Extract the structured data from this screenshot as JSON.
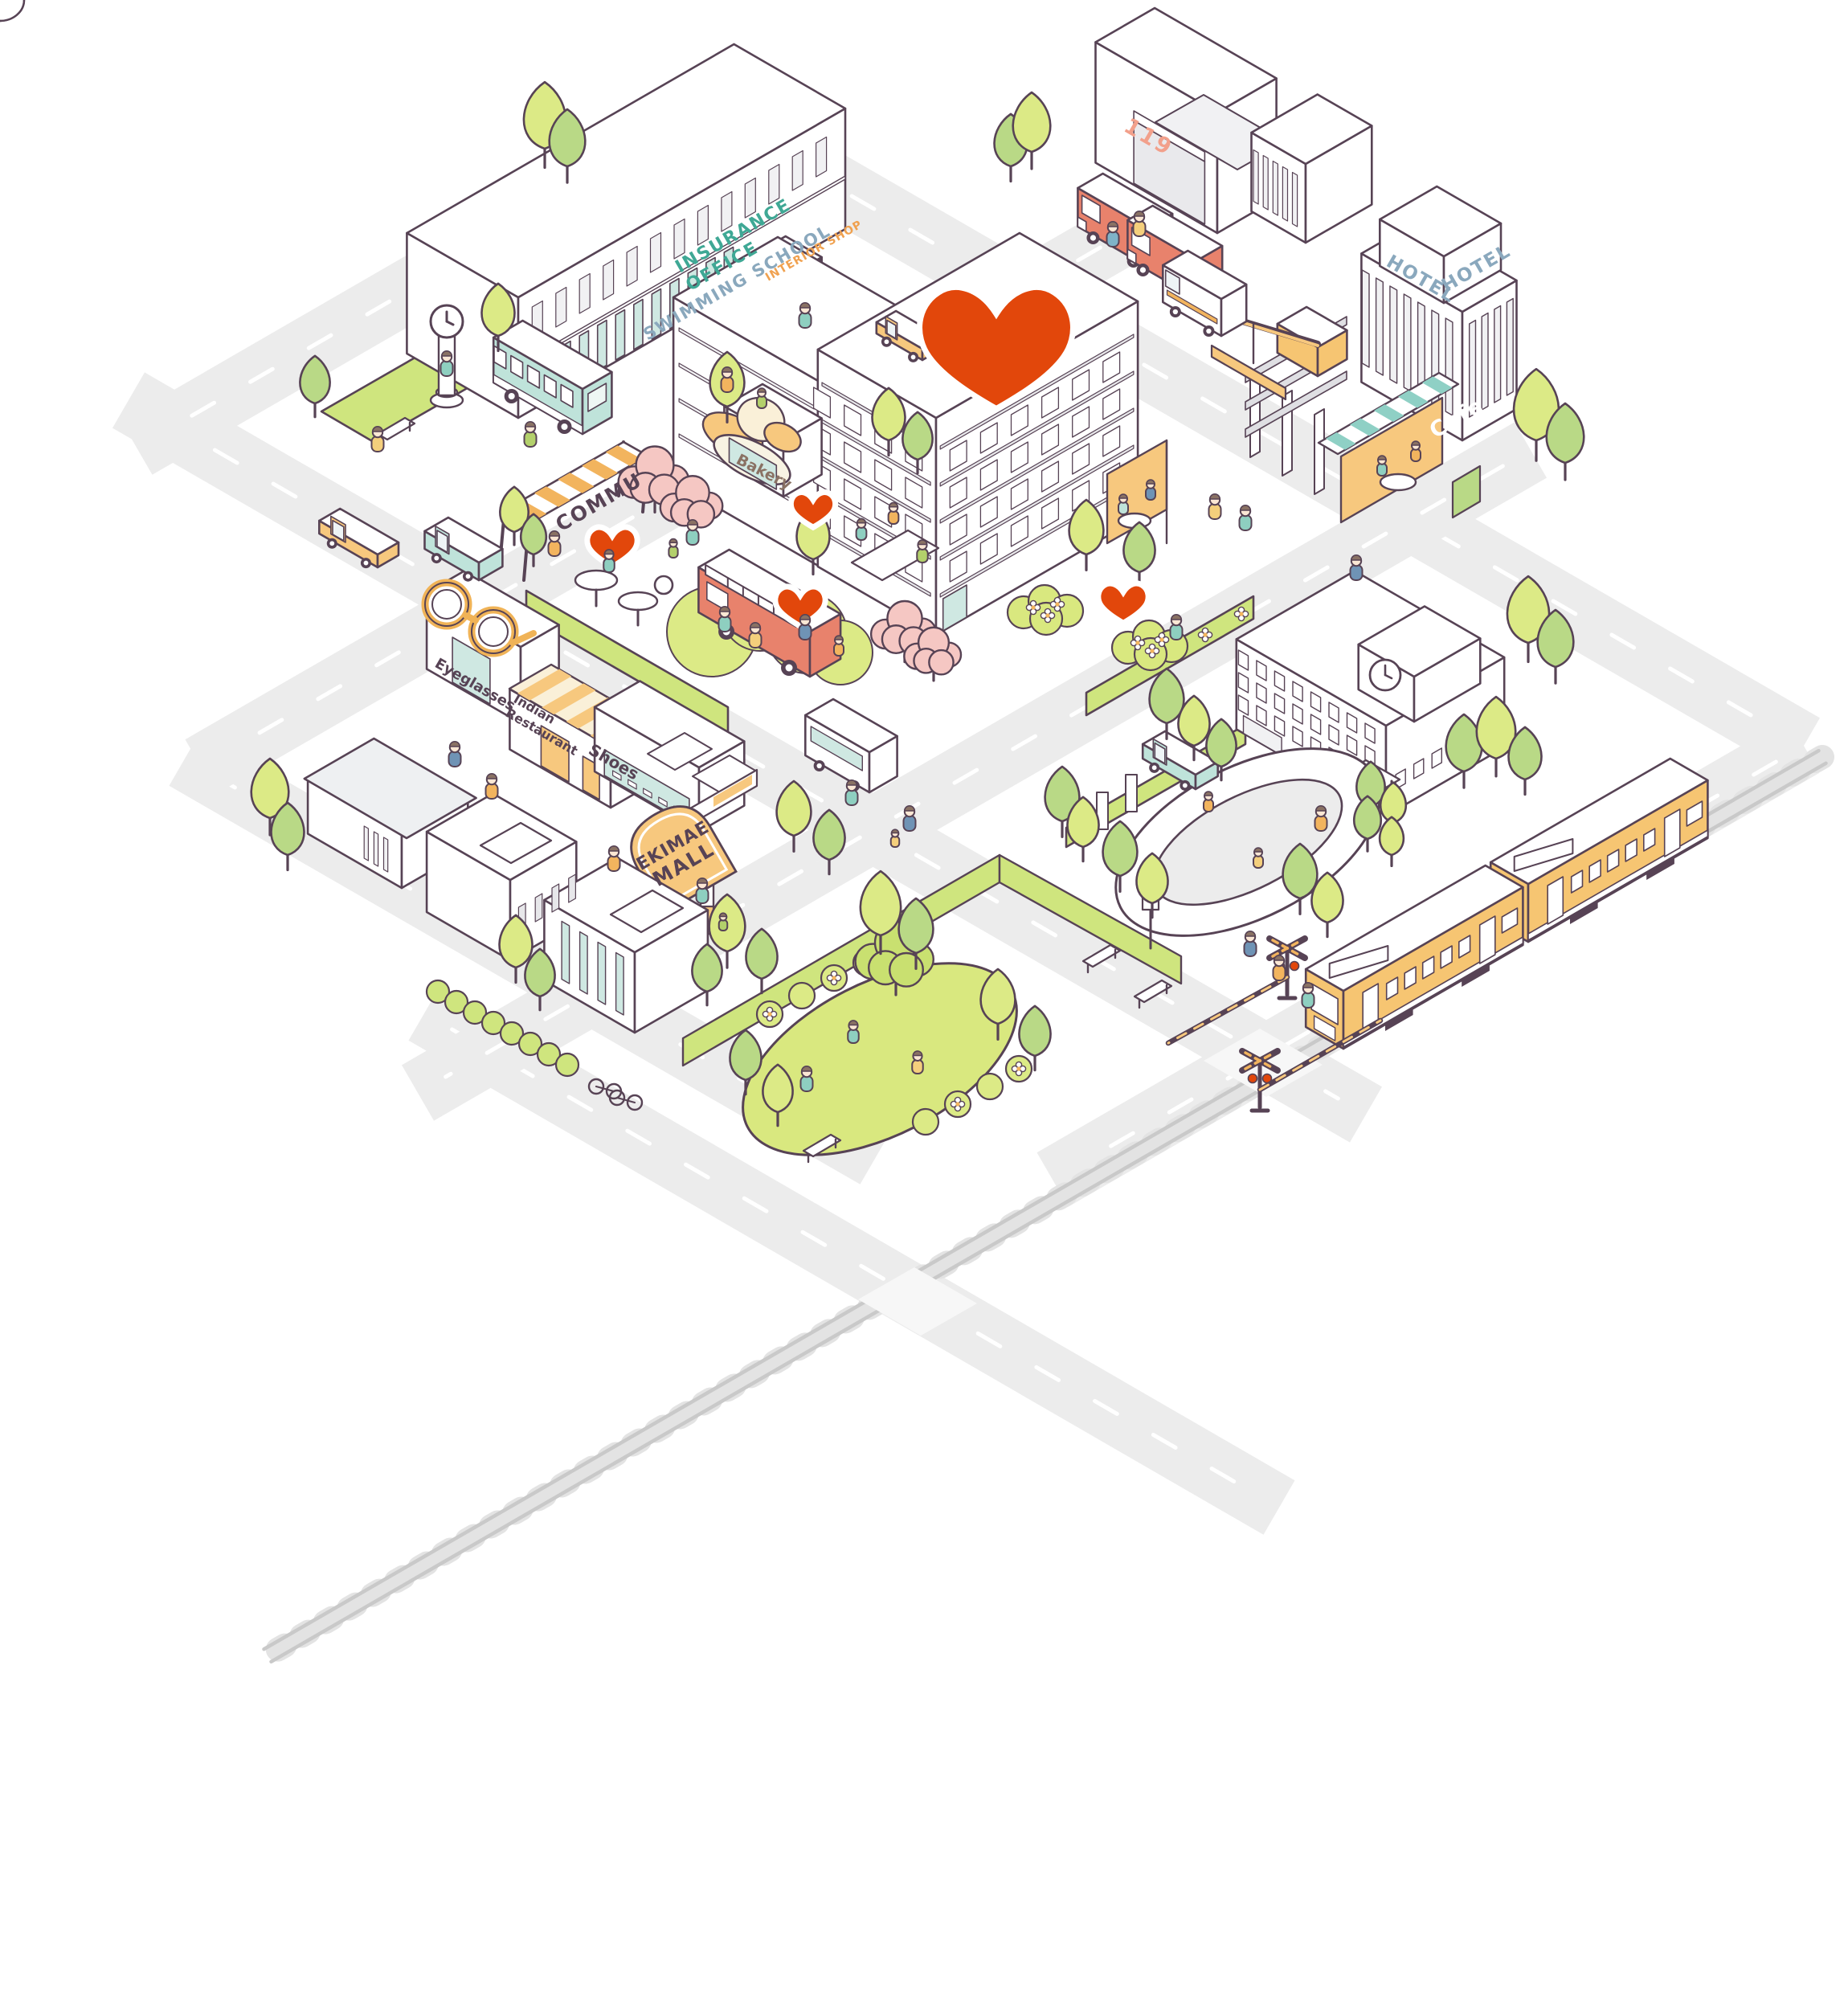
{
  "labels": {
    "insurance_line1": "INSURANCE",
    "insurance_line2": "OFFICE",
    "swimming_school": "SWIMMING SCHOOL",
    "interior_shop": "INTERIOR  SHOP",
    "fire_station_number": "119",
    "hotel": "HOTEL",
    "bakery": "Bakery",
    "commu": "COMMU",
    "cafe": "Cafe",
    "eyeglasses": "Eyeglasses",
    "indian_line1": "Indian",
    "indian_line2": "Restaurant",
    "shoes": "Shoes",
    "mall_line1": "EKIMAE",
    "mall_line2": "MALL"
  },
  "colors": {
    "outline": "#574355",
    "road": "#ececec",
    "road_dash": "#ffffff",
    "lawn": "#cfe57e",
    "lawn_bright": "#d9e87f",
    "green_light": "#dcea86",
    "green_mid": "#b9d986",
    "pink_tree": "#f5c7c3",
    "orange": "#f7c87e",
    "orange_deep": "#f2b45e",
    "cream": "#faf0d8",
    "salmon": "#e8826c",
    "salmon_text": "#f2a08b",
    "heart": "#e2470b",
    "teal_text": "#3fa895",
    "bluegray_text": "#8aa8bd",
    "brown_text": "#8a7264",
    "mint": "#bfe3da",
    "teal_glass": "#cfe8e2",
    "train_yellow": "#f6c572",
    "white": "#ffffff",
    "gray_face": "#f1f1f3",
    "skin": "#fbe7d4",
    "hair": "#8a7264"
  }
}
